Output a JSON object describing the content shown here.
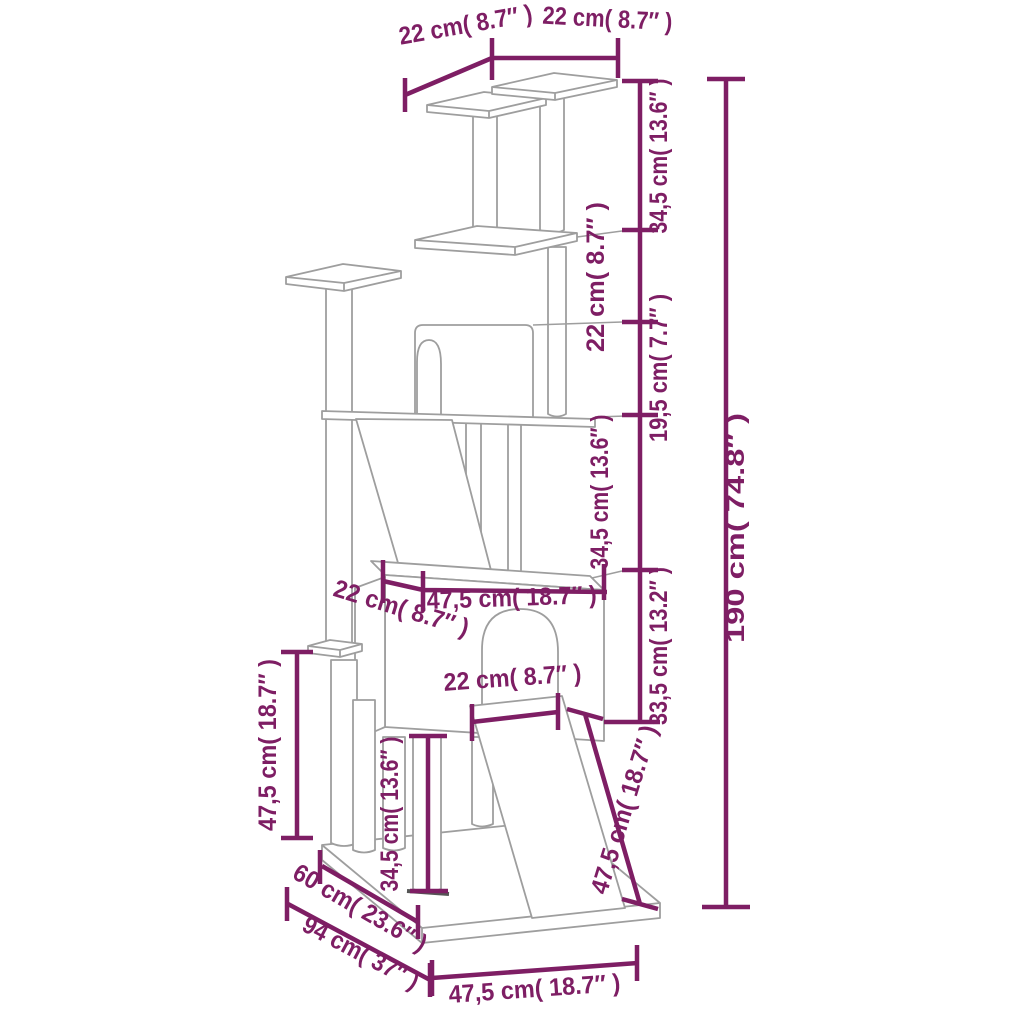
{
  "diagram": {
    "kind": "product-dimension-drawing",
    "subject": "cat-tree-with-scratching-posts",
    "colors": {
      "dimension_accent": "#7e1e64",
      "drawing_line": "#9e9e9e",
      "background": "#ffffff"
    },
    "labels": {
      "top_platform_left": "22 cm( 8.7″ )",
      "top_platform_right": "22 cm( 8.7″ )",
      "level_top_to_middle": "34,5 cm( 13.6″ )",
      "level_middle_to_condo_roof": "22 cm( 8.7″ )",
      "level_condo_roof_to_platform": "19,5 cm( 7.7″ )",
      "level_platform_to_house_top": "34,5 cm( 13.6″ )",
      "house_height": "33,5 cm( 13.2″ )",
      "total_height": "190 cm( 74.8″ )",
      "house_top_depth": "22 cm( 8.7″ )",
      "house_width": "47,5 cm( 18.7″ )",
      "door_width": "22 cm( 8.7″ )",
      "ramp_length": "47,5 cm( 18.7″ )",
      "left_post_height": "47,5 cm( 18.7″ )",
      "lower_post_height": "34,5 cm( 13.6″ )",
      "base_upper_depth": "60 cm( 23.6″ )",
      "base_total_depth": "94 cm( 37″ )",
      "base_width": "47,5 cm( 18.7″ )"
    }
  }
}
